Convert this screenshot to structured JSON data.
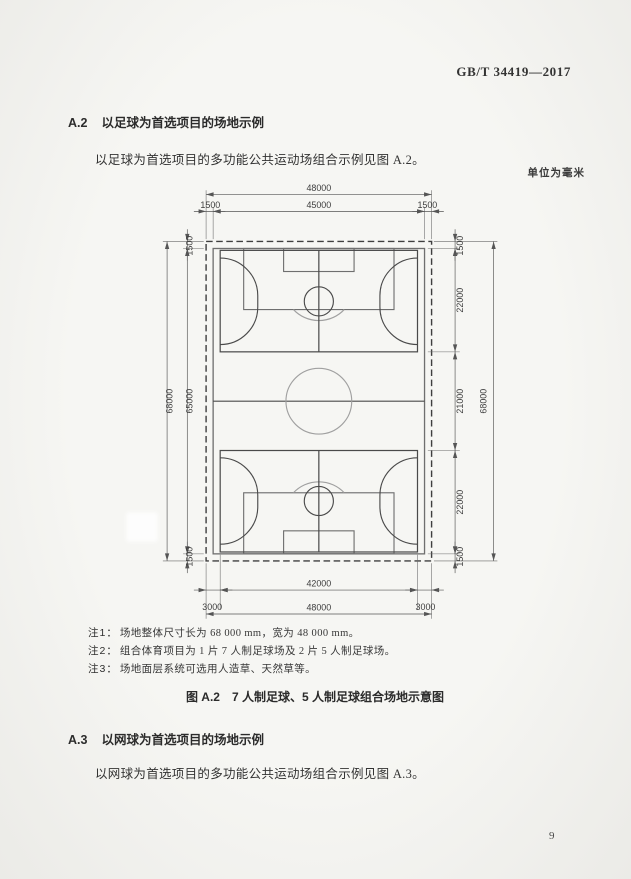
{
  "header": {
    "standard_number": "GB/T 34419—2017"
  },
  "sections": {
    "a2": {
      "number": "A.2",
      "title": "以足球为首选项目的场地示例",
      "body": "以足球为首选项目的多功能公共运动场组合示例见图 A.2。"
    },
    "a3": {
      "number": "A.3",
      "title": "以网球为首选项目的场地示例",
      "body": "以网球为首选项目的多功能公共运动场组合示例见图 A.3。"
    }
  },
  "figure": {
    "unit_note": "单位为毫米",
    "caption_number": "图 A.2",
    "caption_title": "7 人制足球、5 人制足球组合场地示意图",
    "notes": [
      {
        "label": "注1：",
        "text": "场地整体尺寸长为 68 000 mm，宽为 48 000 mm。"
      },
      {
        "label": "注2：",
        "text": "组合体育项目为 1 片 7 人制足球场及 2 片 5 人制足球场。"
      },
      {
        "label": "注3：",
        "text": "场地面层系统可选用人造草、天然草等。"
      }
    ],
    "dimensions": {
      "top_total": "48000",
      "top_left_margin": "1500",
      "top_inner": "45000",
      "top_right_margin": "1500",
      "bottom_inner": "42000",
      "bottom_left_margin": "3000",
      "bottom_right_margin": "3000",
      "bottom_total": "48000",
      "left_total": "68000",
      "left_top_margin": "1500",
      "left_inner": "65000",
      "left_bottom_margin": "1500",
      "right_top_margin": "1500",
      "right_zone_top": "22000",
      "right_zone_middle": "21000",
      "right_zone_bottom": "22000",
      "right_bottom_margin": "1500",
      "right_total": "68000"
    },
    "diagram_colors": {
      "dark_line": "#4a4a4a",
      "medium_line": "#6f6f6f",
      "light_line": "#a0a0a0",
      "dim_line": "#555555"
    }
  },
  "footer": {
    "page_number": "9"
  }
}
